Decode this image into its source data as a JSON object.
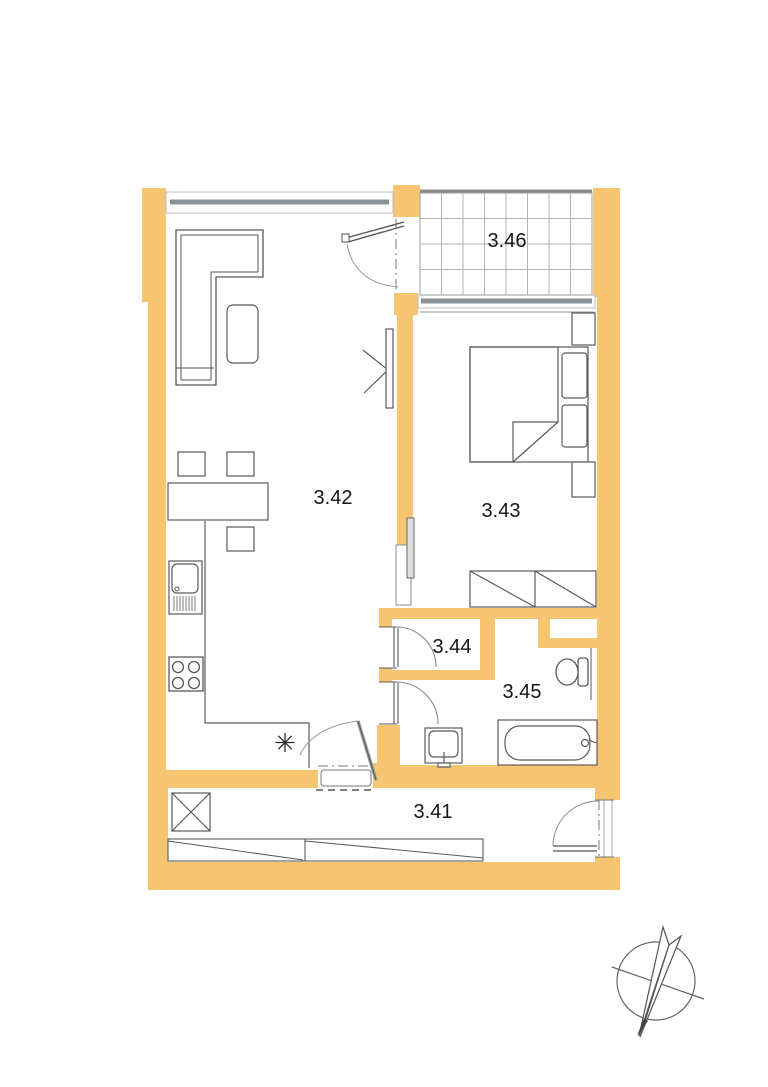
{
  "colors": {
    "wall": "#F5C572",
    "furniture_line": "#5a5a5a",
    "window_glass": "#8D9499",
    "balcony_grid": "#b3b3b3",
    "label_text": "#151515"
  },
  "rooms": {
    "hall": {
      "label": "3.41"
    },
    "living_kitchen": {
      "label": "3.42"
    },
    "bedroom": {
      "label": "3.43"
    },
    "storage": {
      "label": "3.44"
    },
    "bathroom": {
      "label": "3.45"
    },
    "balcony": {
      "label": "3.46"
    }
  },
  "symbols": {
    "appliance_marker": "✳",
    "north_arrow": "north-arrow-compass"
  }
}
